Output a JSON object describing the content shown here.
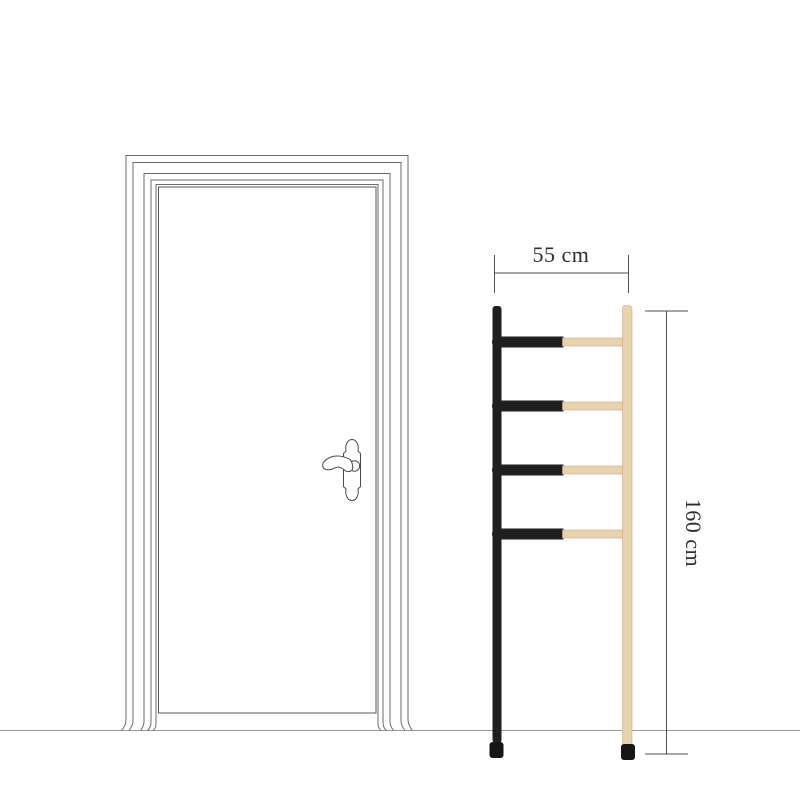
{
  "background": "#ffffff",
  "dimensions": {
    "width_label": "55 cm",
    "height_label": "160 cm",
    "line_color": "#4f4f4f",
    "text_color": "#2f2f2f"
  },
  "door": {
    "line_color": "#6b6b6b",
    "panel_line_color": "#5a5a5a",
    "handle_line_color": "#4a4a4a"
  },
  "floor": {
    "line_color": "#9a9a9a"
  },
  "ladder": {
    "rung_count": 4,
    "black_color": "#1f1f1f",
    "wood_color": "#e9d2ae",
    "wood_edge_color": "#c9ab7f",
    "foot_color": "#161616"
  }
}
